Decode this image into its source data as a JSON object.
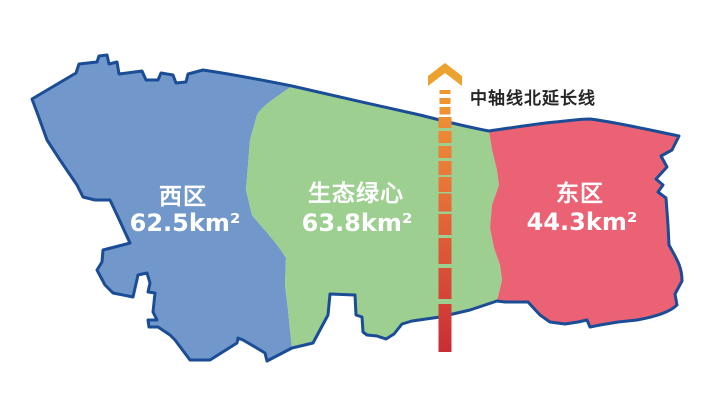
{
  "map": {
    "outline_color": "#1A4D96",
    "background": "#ffffff",
    "label_text_color": "#ffffff"
  },
  "regions": [
    {
      "id": "west",
      "name": "西区",
      "area": "62.5km²",
      "color": "#7298CB"
    },
    {
      "id": "green-heart",
      "name": "生态绿心",
      "area": "63.8km²",
      "color": "#9CCF90"
    },
    {
      "id": "east",
      "name": "东区",
      "area": "44.3km²",
      "color": "#EA6273"
    }
  ],
  "axis": {
    "label": "中轴线北延长线",
    "label_color": "#262626",
    "arrow_color": "#EDA22F",
    "gradient_top": "#F0A32E",
    "gradient_mid": "#E9773A",
    "gradient_bottom": "#C92D35"
  }
}
